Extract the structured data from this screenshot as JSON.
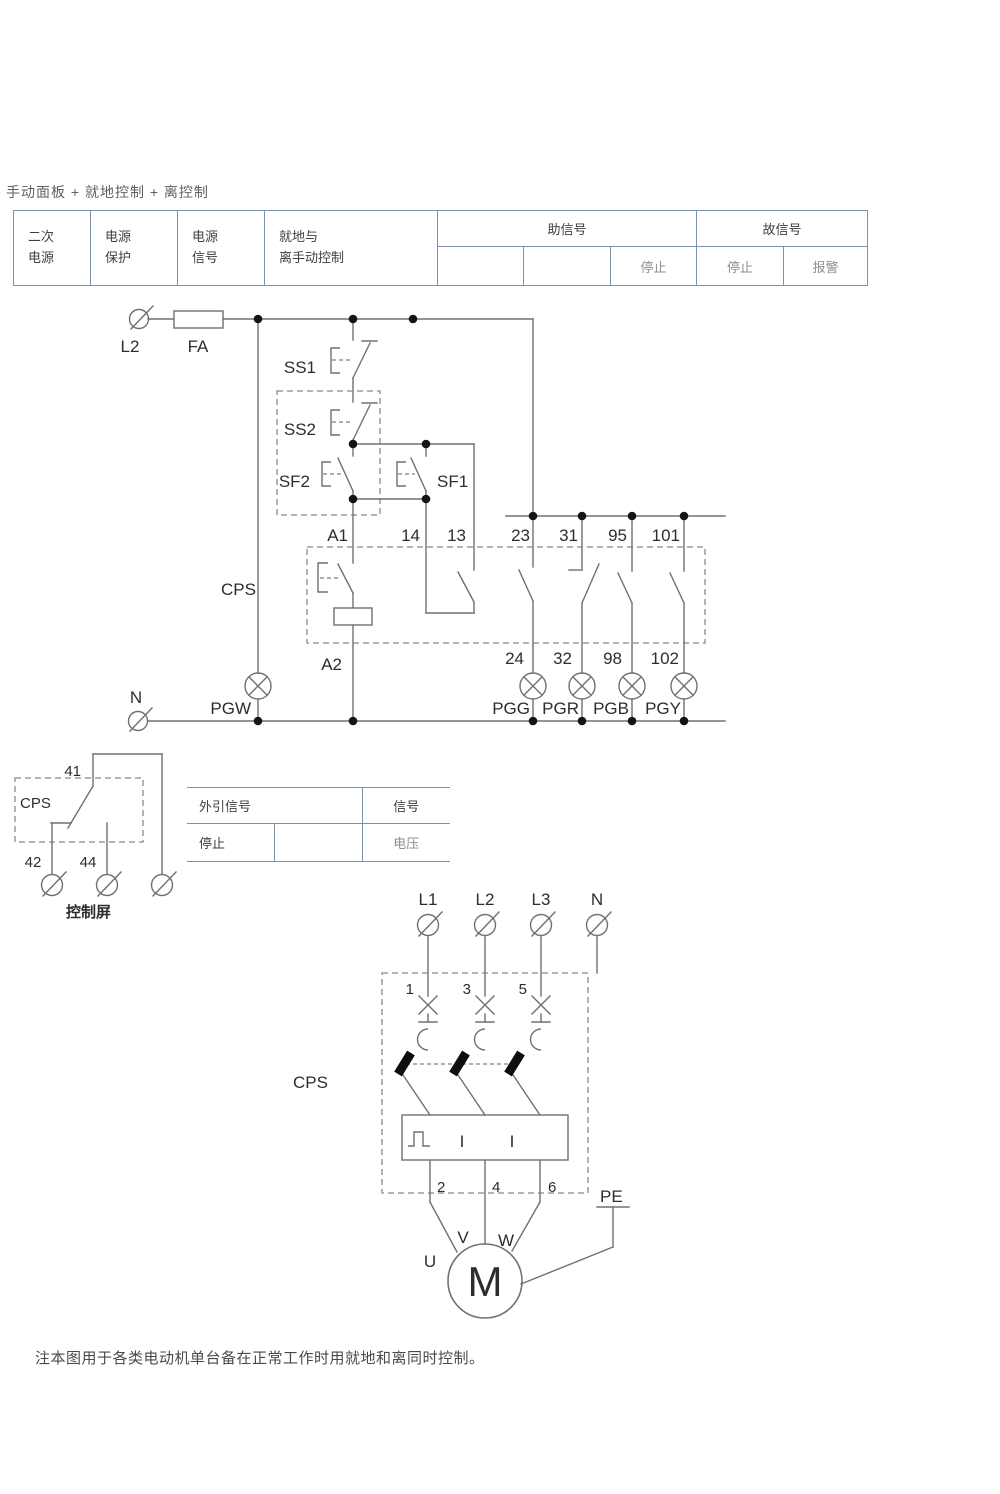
{
  "page": {
    "title": "手动面板 + 就地控制 + 离控制",
    "note": "注本图用于各类电动机单台备在正常工作时用就地和离同时控制。"
  },
  "signal_table": {
    "c1a": "二次",
    "c1b": "电源",
    "c2a": "电源",
    "c2b": "保护",
    "c3a": "电源",
    "c3b": "信号",
    "c4a": "就地与",
    "c4b": "离手动控制",
    "aux_header": "助信号",
    "fault_header": "故信号",
    "aux_stop": "停止",
    "fault_stop": "停止",
    "fault_alarm": "报警"
  },
  "ref_table": {
    "title": "外引信号",
    "signal": "信号",
    "stop": "停止",
    "voltage": "电压"
  },
  "ctrl": {
    "L2": "L2",
    "FA": "FA",
    "SS1": "SS1",
    "SS2": "SS2",
    "SF2": "SF2",
    "SF1": "SF1",
    "CPS": "CPS",
    "A1": "A1",
    "A2": "A2",
    "N": "N",
    "n14": "14",
    "n13": "13",
    "n23": "23",
    "n31": "31",
    "n95": "95",
    "n101": "101",
    "n24": "24",
    "n32": "32",
    "n98": "98",
    "n102": "102",
    "PGW": "PGW",
    "PGG": "PGG",
    "PGR": "PGR",
    "PGB": "PGB",
    "PGY": "PGY"
  },
  "panel": {
    "CPS": "CPS",
    "n41": "41",
    "n42": "42",
    "n44": "44",
    "caption": "控制屏"
  },
  "power": {
    "L1": "L1",
    "L2": "L2",
    "L3": "L3",
    "N": "N",
    "CPS": "CPS",
    "n1": "1",
    "n3": "3",
    "n5": "5",
    "n2": "2",
    "n4": "4",
    "n6": "6",
    "I1": "I",
    "I2": "I",
    "U": "U",
    "V": "V",
    "W": "W",
    "M": "M",
    "PE": "PE"
  }
}
